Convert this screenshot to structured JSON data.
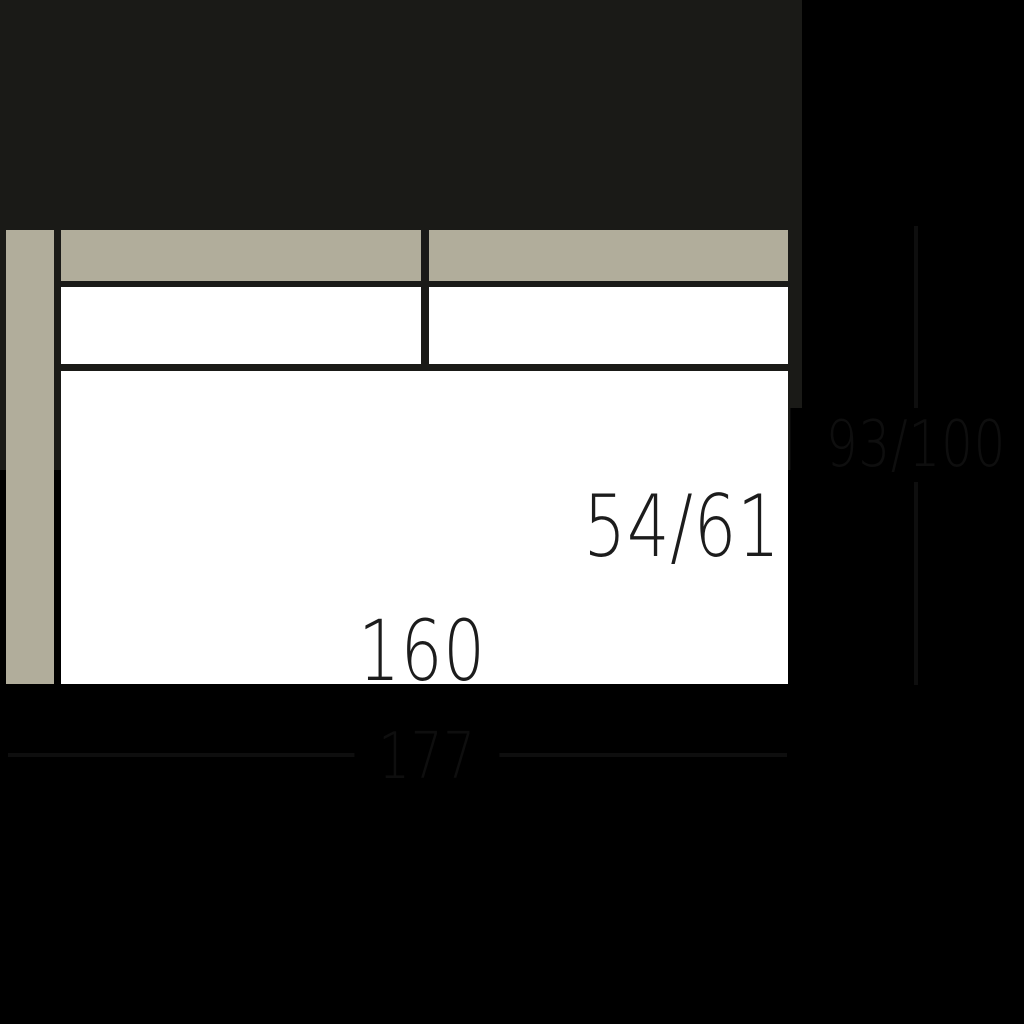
{
  "diagram": {
    "type": "furniture-top-view-dimension-drawing",
    "subject": "sofa element with left armrest, two-section backrest with back cushions, and single seat surface",
    "dimensions": {
      "seat_depth_label": "54/61",
      "seat_width_label": "160",
      "overall_width_label": "177",
      "overall_depth_label": "93/100"
    },
    "parts": [
      "armrest-left",
      "backrest-left",
      "backrest-right",
      "back-cushion-left",
      "back-cushion-right",
      "seat"
    ],
    "colors": {
      "background": "#000000",
      "upholstery": "#b1ad9b",
      "cushion": "#ffffff",
      "outline": "#1a1a17",
      "dimension": "#0e0e0e"
    }
  }
}
